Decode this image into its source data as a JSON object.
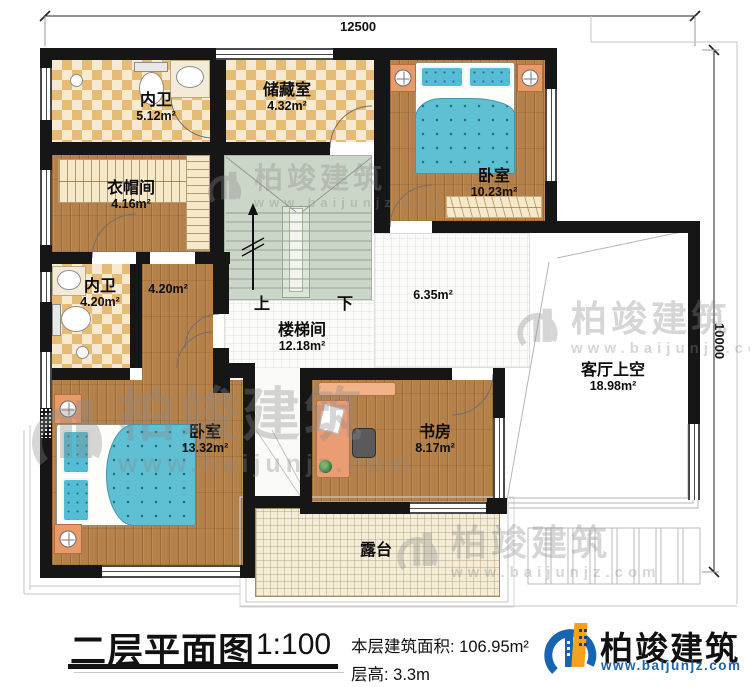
{
  "dimensions": {
    "width_label": "12500",
    "height_label": "10000"
  },
  "rooms": {
    "bath1": {
      "name": "内卫",
      "area": "5.12m²"
    },
    "storage": {
      "name": "储藏室",
      "area": "4.32m²"
    },
    "bedroom1": {
      "name": "卧室",
      "area": "10.23m²"
    },
    "cloakroom": {
      "name": "衣帽间",
      "area": "4.16m²"
    },
    "bath2": {
      "name": "内卫",
      "area": "4.20m²"
    },
    "corridor": {
      "area": "4.20m²"
    },
    "stairwell": {
      "name": "楼梯间",
      "area": "12.18m²",
      "up": "上",
      "down": "下"
    },
    "hall": {
      "area": "6.35m²"
    },
    "bedroom2": {
      "name": "卧室",
      "area": "13.32m²"
    },
    "study": {
      "name": "书房",
      "area": "8.17m²"
    },
    "void": {
      "name": "客厅上空",
      "area": "18.98m²"
    },
    "terrace": {
      "name": "露台"
    }
  },
  "titleblock": {
    "title": "二层平面图",
    "scale": "1:100",
    "area_line": "本层建筑面积: 106.95m²",
    "height_line": "层高: 3.3m"
  },
  "brand": {
    "name": "柏竣建筑",
    "url": "www.baijunjz.com"
  },
  "watermark": {
    "name": "柏竣建筑",
    "url": "www.baijunjz.com"
  }
}
